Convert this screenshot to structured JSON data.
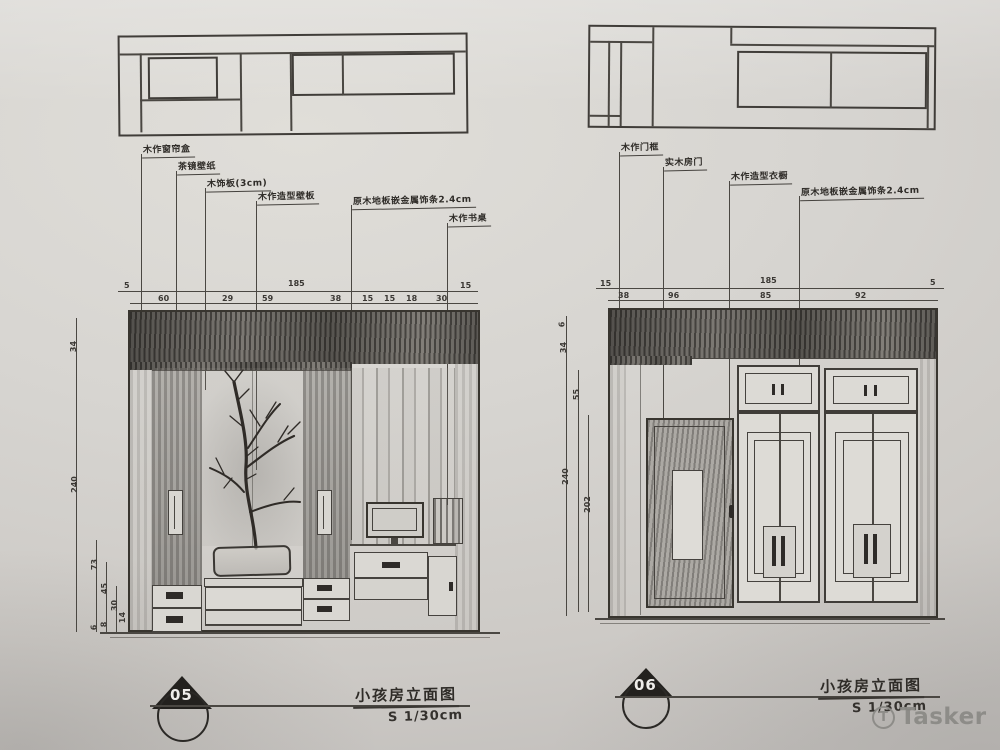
{
  "watermark": {
    "logo_letter": "T",
    "text": "Tasker"
  },
  "left_view": {
    "labels": [
      "木作窗帘盒",
      "茶镜壁纸",
      "木饰板(3cm)",
      "木作造型壁板",
      "原木地板嵌金属饰条2.4cm",
      "木作书桌"
    ],
    "dims_top_row1": [
      "5",
      "185",
      "15"
    ],
    "dims_top_row2": [
      "60",
      "29",
      "59",
      "38",
      "15",
      "15",
      "18",
      "30"
    ],
    "dims_side": [
      "34",
      "240"
    ],
    "dims_side_bottom": [
      "73",
      "45",
      "30",
      "14",
      "8",
      "6"
    ],
    "title_number": "05",
    "title_name": "小孩房立面图",
    "title_scale": "S 1/30cm"
  },
  "right_view": {
    "labels": [
      "木作门框",
      "实木房门",
      "木作造型衣橱",
      "原木地板嵌金属饰条2.4cm"
    ],
    "dims_top_row1": [
      "15",
      "185",
      "5"
    ],
    "dims_top_row2": [
      "38",
      "96",
      "85",
      "92"
    ],
    "dims_side": [
      "6",
      "34",
      "55",
      "240",
      "202"
    ],
    "title_number": "06",
    "title_name": "小孩房立面图",
    "title_scale": "S 1/30cm"
  }
}
